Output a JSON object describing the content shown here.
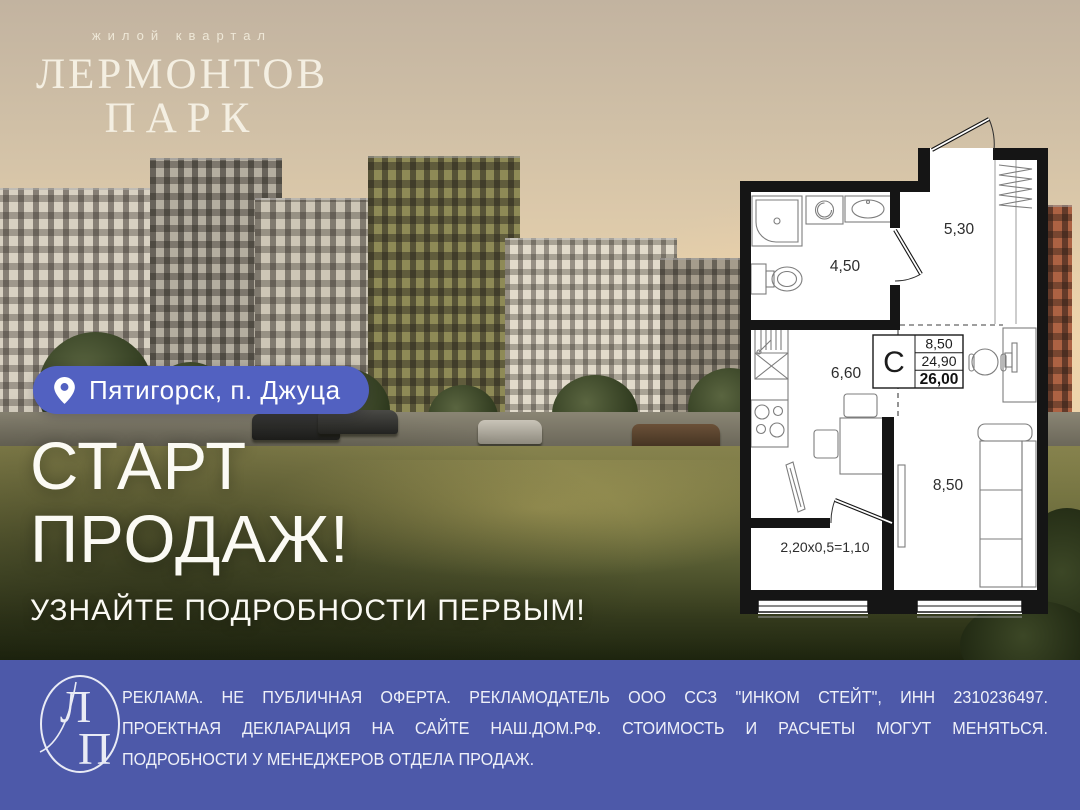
{
  "brand": {
    "tagline": "жилой квартал",
    "title_line1": "ЛЕРМОНТОВ",
    "title_line2": "ПАРК"
  },
  "location_badge": {
    "icon": "location-pin-icon",
    "text": "Пятигорск, п. Джуца"
  },
  "headline": {
    "line1": "СТАРТ",
    "line2": "ПРОДАЖ!",
    "subline": "УЗНАЙТЕ ПОДРОБНОСТИ ПЕРВЫМ!"
  },
  "floor_plan": {
    "rooms": [
      {
        "name": "bathroom",
        "area": "4,50"
      },
      {
        "name": "hallway",
        "area": "5,30"
      },
      {
        "name": "kitchen",
        "area": "6,60"
      },
      {
        "name": "living-room",
        "area": "8,50"
      }
    ],
    "stamp": {
      "type_label": "С",
      "rows": [
        "8,50",
        "24,90",
        "26,00"
      ]
    },
    "balcony_formula": "2,20х0,5=1,10"
  },
  "footer": {
    "monogram_l": "Л",
    "monogram_p": "П",
    "disclaimer_lines": [
      "РЕКЛАМА. НЕ ПУБЛИЧНАЯ ОФЕРТА. РЕКЛАМОДАТЕЛЬ ООО ССЗ \"ИНКОМ СТЕЙТ\", ИНН 2310236497.",
      "ПРОЕКТНАЯ ДЕКЛАРАЦИЯ НА САЙТЕ НАШ.ДОМ.РФ. СТОИМОСТЬ И РАСЧЕТЫ МОГУТ МЕНЯТЬСЯ.",
      "ПОДРОБНОСТИ У МЕНЕДЖЕРОВ ОТДЕЛА ПРОДАЖ."
    ]
  },
  "colors": {
    "badge_bg": "#5261c1",
    "footer_bg": "#4d59a9"
  }
}
